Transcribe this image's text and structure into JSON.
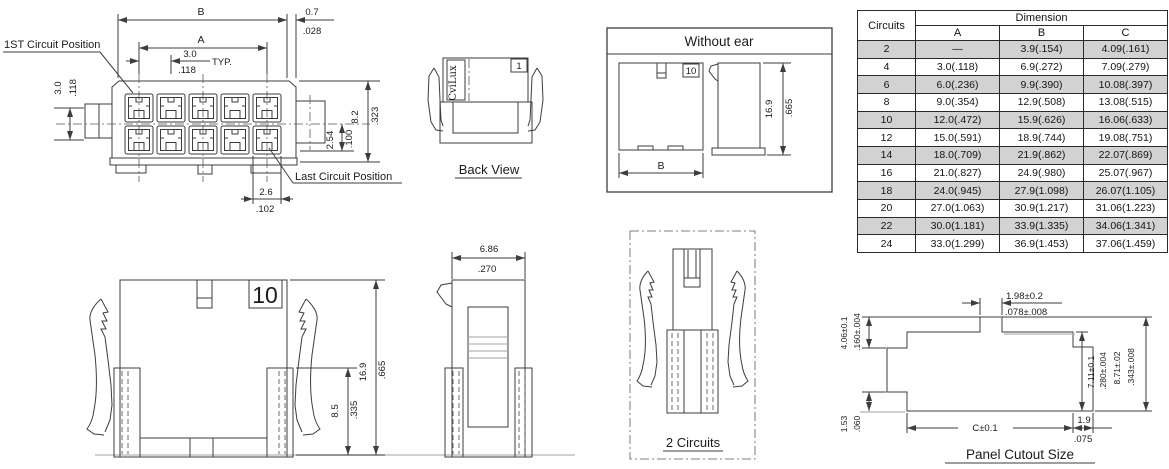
{
  "front_view": {
    "first_circuit_label": "1ST Circuit Position",
    "last_circuit_label": "Last Circuit Position",
    "dim_b": "B",
    "dim_a": "A",
    "dim_0_7": "0.7",
    "dim_0_7_in": ".028",
    "pitch": "3.0",
    "pitch_in": ".118",
    "typ_label": "TYP.",
    "row_pitch": "3.0",
    "row_pitch_in": ".118",
    "dim_2_54": "2.54",
    "dim_2_54_in": ".100",
    "dim_8_2": "8.2",
    "dim_8_2_in": ".323",
    "dim_2_6": "2.6",
    "dim_2_6_in": ".102"
  },
  "back_view": {
    "title": "Back View",
    "brand": "CviLux",
    "pin1": "1"
  },
  "without_ear": {
    "title": "Without ear",
    "pin10": "10",
    "dim_b": "B",
    "dim_16_9": "16.9",
    "dim_16_9_in": ".665"
  },
  "ear_front_view": {
    "pin10": "10",
    "dim_16_9": "16.9",
    "dim_16_9_in": ".665",
    "dim_8_5": "8.5",
    "dim_8_5_in": ".335"
  },
  "side_view": {
    "dim_6_86": "6.86",
    "dim_6_86_in": ".270"
  },
  "two_circuits": {
    "title": "2 Circuits"
  },
  "panel_cutout": {
    "title": "Panel Cutout Size",
    "dim_1_98": "1.98±0.2",
    "dim_1_98_in": ".078±.008",
    "dim_4_06": "4.06±0.1",
    "dim_4_06_in": ".160±.004",
    "dim_1_53": "1.53",
    "dim_1_53_in": ".060",
    "dim_7_11": "7.11±0.1",
    "dim_7_11_in": ".280±.004",
    "dim_8_71": "8.71±.02",
    "dim_8_71_in": ".343±.008",
    "dim_c": "C±0.1",
    "dim_1_9": "1.9",
    "dim_1_9_in": ".075"
  },
  "table": {
    "circuits_header": "Circuits",
    "dimension_header": "Dimension",
    "columns": [
      "A",
      "B",
      "C"
    ],
    "rows": [
      [
        "2",
        "—",
        "3.9(.154)",
        "4.09(.161)"
      ],
      [
        "4",
        "3.0(.118)",
        "6.9(.272)",
        "7.09(.279)"
      ],
      [
        "6",
        "6.0(.236)",
        "9.9(.390)",
        "10.08(.397)"
      ],
      [
        "8",
        "9.0(.354)",
        "12.9(.508)",
        "13.08(.515)"
      ],
      [
        "10",
        "12.0(.472)",
        "15.9(.626)",
        "16.06(.633)"
      ],
      [
        "12",
        "15.0(.591)",
        "18.9(.744)",
        "19.08(.751)"
      ],
      [
        "14",
        "18.0(.709)",
        "21.9(.862)",
        "22.07(.869)"
      ],
      [
        "16",
        "21.0(.827)",
        "24.9(.980)",
        "25.07(.967)"
      ],
      [
        "18",
        "24.0(.945)",
        "27.9(1.098)",
        "26.07(1.105)"
      ],
      [
        "20",
        "27.0(1.063)",
        "30.9(1.217)",
        "31.06(1.223)"
      ],
      [
        "22",
        "30.0(1.181)",
        "33.9(1.335)",
        "34.06(1.341)"
      ],
      [
        "24",
        "33.0(1.299)",
        "36.9(1.453)",
        "37.06(1.459)"
      ]
    ]
  }
}
